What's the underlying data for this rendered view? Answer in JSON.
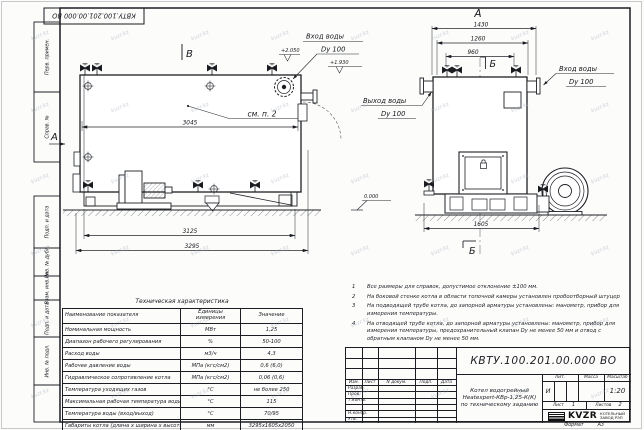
{
  "watermark": {
    "text": "kvzr.kz"
  },
  "stamp_top": {
    "code": "КВТУ.100.201.00.000 ВО"
  },
  "margin_labels": {
    "perv_primen": "Перв. примен.",
    "sprav_no": "Справ. №",
    "podp_data1": "Подп. и дата",
    "inv_dubl": "Инв. № дубл.",
    "vzam_inv": "Взам. инв. №",
    "podp_data2": "Подп. и дата",
    "inv_podl": "Инв. № подл."
  },
  "side_view": {
    "marker_b": "В",
    "marker_a": "А",
    "see_note": "см. п. 2",
    "dim_3045": "3045",
    "dim_3125": "3125",
    "dim_3295": "3295",
    "inlet_label": "Вход воды",
    "inlet_dn": "Dy 100",
    "elev_top": "+2.050",
    "elev_pipe": "+1.930",
    "elev_zero": "0.000"
  },
  "front_view": {
    "marker_a": "А",
    "marker_b_top": "Б",
    "marker_b_bottom": "Б",
    "dim_1430": "1430",
    "dim_1260": "1260",
    "dim_960": "960",
    "dim_1605": "1605",
    "outlet_label": "Выход воды",
    "outlet_dn": "Dy 100",
    "inlet_label": "Вход воды",
    "inlet_dn": "Dy 100"
  },
  "tech_table": {
    "title": "Техническая характеристика",
    "headers": {
      "name": "Наименование показателя",
      "units": "Единицы измерения",
      "value": "Значение"
    },
    "rows": [
      {
        "name": "Номинальная мощность",
        "units": "МВт",
        "value": "1,25"
      },
      {
        "name": "Диапазон рабочего регулирования",
        "units": "%",
        "value": "50-100"
      },
      {
        "name": "Расход воды",
        "units": "м3/ч",
        "value": "4,3"
      },
      {
        "name": "Рабочее давление воды",
        "units": "МПа (кгс/см2)",
        "value": "0,6 (6,0)"
      },
      {
        "name": "Гидравлическое сопротивление котла",
        "units": "МПа (кгс/см2)",
        "value": "0,06 (0,6)"
      },
      {
        "name": "Температура уходящих газов",
        "units": "°С",
        "value": "не более 250"
      },
      {
        "name": "Максимальная рабочая температура воды",
        "units": "°С",
        "value": "115"
      },
      {
        "name": "Температура воды (вход/выход)",
        "units": "°С",
        "value": "70/95"
      },
      {
        "name": "Габариты котла (длина х ширина х высота)",
        "units": "мм",
        "value": "3295х1605х2050"
      }
    ]
  },
  "notes": {
    "items": [
      {
        "num": "1",
        "text": "Все размеры для справок, допустимое отклонение ±100 мм."
      },
      {
        "num": "2",
        "text": "На боковой стенке котла в области топочной камеры установлен пробоотборный штуцер"
      },
      {
        "num": "3",
        "text": "На подводящей трубе котла, до запорной арматуры установлены: манометр, прибор для измерения температуры."
      },
      {
        "num": "4",
        "text": "На отводящей трубе котла, до запорной арматуры установлены: манометр, прибор для измерения температуры, предохранительный клапан Dу не менее 50 мм и отвод с обратным клапаном Dу не менее 50 мм."
      }
    ]
  },
  "title_block": {
    "doc_number": "КВТУ.100.201.00.000 ВО",
    "product_name_line1": "Котел водогрейный",
    "product_name_line2": "Heatexpert-КВр-1,25-К(К)",
    "product_name_line3": "по техническому заданию",
    "col_izm": "Изм.",
    "col_list": "Лист",
    "col_ndoc": "N докум.",
    "col_podp": "Подп.",
    "col_data": "Дата",
    "row_razrab": "Разраб.",
    "row_prov": "Пров.",
    "row_tkontr": "Т.контр.",
    "row_nkontr": "Н.контр.",
    "row_utv": "Утв.",
    "lit_header": "Лит.",
    "mass_header": "Масса",
    "scale_header": "Масштаб",
    "lit_value": "И",
    "scale_value": "1:20",
    "sheet_label": "Лист",
    "sheet_value": "1",
    "sheets_label": "Листов",
    "sheets_value": "2",
    "logo_text": "KVZR",
    "logo_sub1": "КОТЕЛЬНЫЙ",
    "logo_sub2": "ЗАВОД РЭП",
    "format_label": "Формат",
    "format_value": "А3"
  }
}
